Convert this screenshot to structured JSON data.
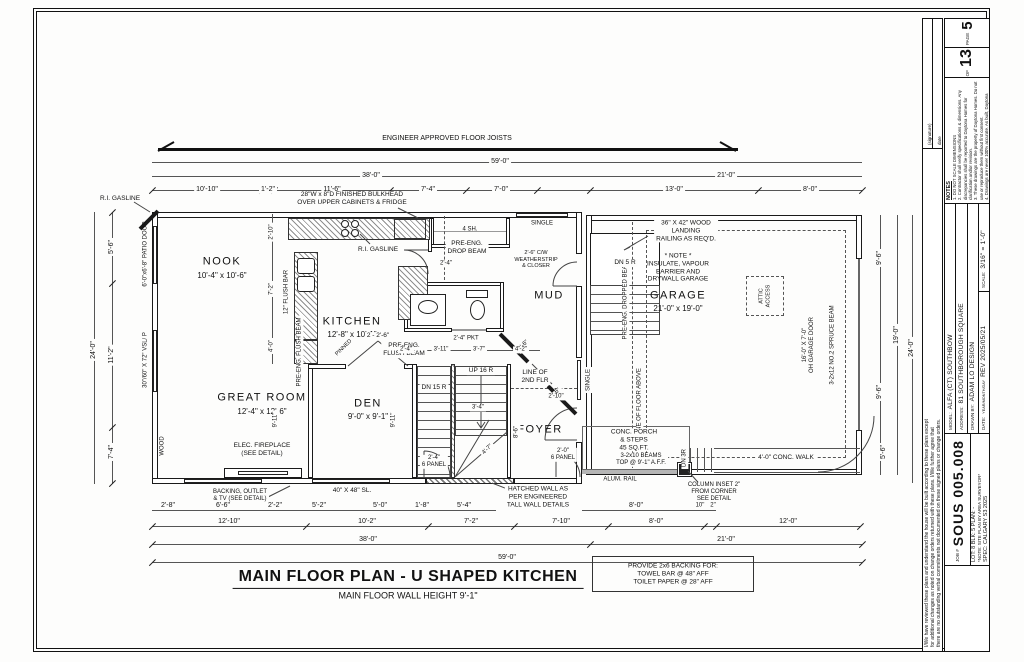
{
  "title_block": {
    "page_label": "PAGE",
    "page_number": "5",
    "of_label": "OF",
    "page_total": "13",
    "notes_title": "NOTES",
    "notes": [
      "1. DO NOT SCALE DIMENSIONS",
      "2. Contractor shall verify specifications & dimensions. Any discrepancies shall be reported to Daytona Homes for clarification and/or revision.",
      "3. These drawings are the property of Daytona Homes. Do not use or reproduce them without first consent.",
      "4. Drawings are never 100% accurate. As built, Daytona Homes reserves the right to make corrections to errors on plans."
    ],
    "model_label": "MODEL:",
    "model": "ALFA (CT) SOUTHBOW",
    "address_label": "ADDRESS:",
    "address": "81 SOUTHBOROUGH SQUARE",
    "drawn_label": "DRAWN BY:",
    "drawn_by": "ADAM LO DESIGN",
    "date_label": "DATE:",
    "date_sub": "YEAR/MONTH/DAY",
    "date": "REV 2025/05/21",
    "scale_label": "SCALE:",
    "scale": "3/16\" = 1'-0\"",
    "job_label": "JOB #",
    "job_number": "SOUS 005.008",
    "lot_line": "LOT: 8   BLK: 5   PLAN: -",
    "site_note": "*NOTE: SITE PLAN BY AREA SURVEYOR*",
    "spec_line": "SPEC: CALGARY S3 2025",
    "disclaimer": [
      "I/We have reviewed these plans and understand the house will be built according to these plans except",
      "for additional changes as noted on change orders returned with these plans. I/We further agree that",
      "there are no outstanding verbal commitments not documented on these signed plans or change orders."
    ],
    "signature_label": "(signature)",
    "date_sig_label": "date"
  },
  "plan": {
    "title": "MAIN FLOOR PLAN - U SHAPED KITCHEN",
    "subtitle": "MAIN FLOOR WALL HEIGHT 9'-1\"",
    "backing_note": "PROVIDE 2x6 BACKING FOR:\nTOWEL BAR @ 48\" AFF\nTOILET PAPER @ 28\" AFF",
    "rooms": {
      "nook": {
        "name": "NOOK",
        "dims": "10'-4\" x 10'-6\""
      },
      "kitchen": {
        "name": "KITCHEN",
        "dims": "12'-8\" x 10'-1\""
      },
      "great_room": {
        "name": "GREAT ROOM",
        "dims": "12'-4\" x 12'-6\""
      },
      "den": {
        "name": "DEN",
        "dims": "9'-0\" x 9'-1\""
      },
      "foyer": {
        "name": "FOYER"
      },
      "mud": {
        "name": "MUD"
      },
      "garage": {
        "name": "GARAGE",
        "dims": "21'-0\" x 19'-0\""
      }
    },
    "ann": {
      "joists": "ENGINEER APPROVED FLOOR JOISTS",
      "bulkhead": "28\"W x 8\"D FINISHED BULKHEAD\nOVER UPPER CABINETS & FRIDGE",
      "ri_gasline": "R.I. GASLINE",
      "four_sh": "4 SH.",
      "single": "SINGLE",
      "drop_beam": "PRE-ENG.\nDROP BEAM",
      "flush_beam": "PRE-ENG.\nFLUSH BEAM",
      "flush_beam_v": "PRE-ENG. FLUSH BEAM",
      "flush_bar": "12\" FLUSH BAR",
      "weatherstrip": "2'-6\" C/W\nWEATHERSTRIP\n& CLOSER",
      "dn5": "DN 5 R",
      "up16": "UP 16 R",
      "dn15": "DN 15 R",
      "dn3": "DN 3R",
      "landing_note": "36\" X 42\" WOOD\nLANDING\nRAILING AS REQ'D.",
      "garage_note": "* NOTE *\nINSULATE, VAPOUR\nBARRIER AND\nDRYWALL GARAGE",
      "dropped_beam": "PRE-ENG. DROPPED BEAM",
      "floor_above": "LINE OF FLOOR ABOVE",
      "oh_door": "16'-0\" X 7'-0\"\nOH GARAGE DOOR",
      "spruce_beam": "3-2x12 NO.2 SPRUCE BEAM",
      "attic": "ATTIC\nACCESS",
      "line_2nd": "LINE OF\n2ND FLR",
      "hatched_wall": "HATCHED WALL AS\nPER ENGINEERED\nTALL WALL DETAILS",
      "porch": "CONC. PORCH\n& STEPS\n45 SQ.FT.",
      "beams": "3-2x10 BEAMS\nTOP @ 9'-1\" A.F.F.",
      "alum_rail": "ALUM. RAIL",
      "column_note": "COLUMN INSET 2\"\nFROM CORNER\nSEE DETAIL",
      "conc_walk": "4'-0\" CONC. WALK",
      "fireplace": "ELEC. FIREPLACE\n(SEE DETAIL)",
      "backing_tv": "BACKING, OUTLET\n& TV (SEE DETAIL)",
      "sl_window": "40\" X 48\" SL.",
      "patio_door": "6'-0\"x6'-8\" PATIO DOOR",
      "vsl_window": "30\"/60\" X 72\" VSL/ P",
      "wood": "WOOD",
      "pinned": "PINNED",
      "pkt": "2'-4\" PKT",
      "panel20": "2'-0\"\n6 PANEL",
      "panel24": "2'-4\"\n6 PANEL",
      "den_doors": "2 - 2'-6\"",
      "door24": "2'-4\"",
      "door26": "2'-6\""
    },
    "dims": {
      "top1": [
        "10'-10\"",
        "1'-2\"",
        "11'-6\"",
        "7'-4\"",
        "7'-0\"",
        "13'-0\"",
        "8'-0\""
      ],
      "top2": [
        "38'-0\"",
        "21'-0\""
      ],
      "overall": "59'-0\"",
      "bottomA": [
        "2'-8\"",
        "6'-6\"",
        "2'-2\"",
        "5'-2\"",
        "5'-0\"",
        "1'-8\"",
        "5'-4\"",
        "8'-0\"",
        "10\"",
        "2\""
      ],
      "bottomB": [
        "12'-10\"",
        "10'-2\"",
        "7'-2\"",
        "7'-10\"",
        "8'-0\"",
        "12'-0\""
      ],
      "left": [
        "5'-6\"",
        "11'-2\"",
        "7'-4\"",
        "24'-0\""
      ],
      "right": [
        "9'-6\"",
        "9'-6\"",
        "19'-0\"",
        "24'-0\"",
        "5'-6\""
      ],
      "kitchen": [
        "2'-10\"",
        "7'-2\"",
        "4'-0\""
      ],
      "mud": [
        "2'-4\"",
        "3'-11\"",
        "3'-7\"",
        "4'-2\""
      ],
      "stair": [
        "8'-6\"",
        "2'-10\"",
        "3'-4\"",
        "4'-7\"",
        "9'-11\""
      ]
    }
  }
}
